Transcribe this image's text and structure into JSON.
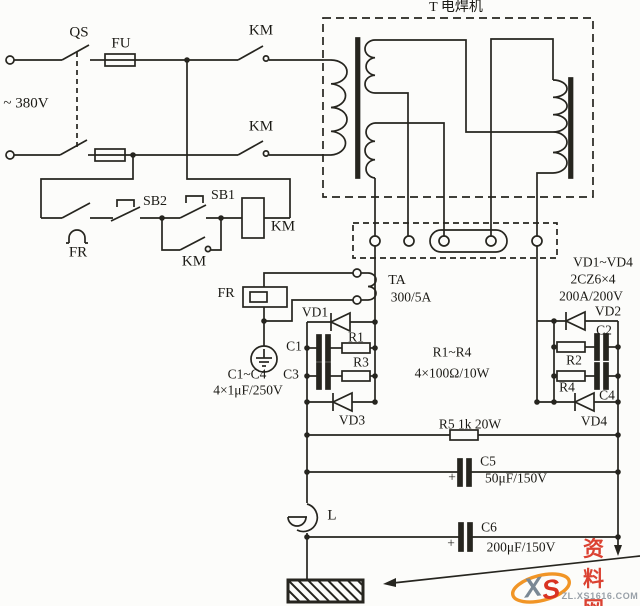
{
  "colors": {
    "line": "#26251f",
    "label": "#1b1a15",
    "background": "#fcfcfa",
    "wm_red": "#d93322",
    "wm_orange": "#ee8200",
    "wm_gray": "#98a0a8"
  },
  "power": {
    "supply": "~ 380V",
    "qs": "QS",
    "fu": "FU",
    "km_top": "KM",
    "km_mid": "KM"
  },
  "control": {
    "fr_contact": "FR",
    "sb2": "SB2",
    "sb1": "SB1",
    "km_coil": "KM",
    "km_aux": "KM",
    "fr_heater": "FR"
  },
  "transformer": {
    "title": "T 电焊机"
  },
  "ta": {
    "name": "TA",
    "ratio": "300/5A"
  },
  "rectifier": {
    "note1": "VD1~VD4",
    "note2": "2CZ6×4",
    "note3": "200A/200V",
    "vd1": "VD1",
    "vd2": "VD2",
    "vd3": "VD3",
    "vd4": "VD4",
    "c1": "C1",
    "c2": "C2",
    "c3": "C3",
    "c4": "C4",
    "r1": "R1",
    "r2": "R2",
    "r3": "R3",
    "r4": "R4",
    "r_note1": "R1~R4",
    "r_note2": "4×100Ω/10W",
    "c_note1": "C1~C4",
    "c_note2": "4×1μF/250V"
  },
  "output": {
    "r5": "R5 1k 20W",
    "c5": "C5",
    "c5_value": "50μF/150V",
    "c5_plus": "+",
    "c6": "C6",
    "c6_value": "200μF/150V",
    "c6_plus": "+",
    "l": "L"
  },
  "watermark": {
    "logo_x": "X",
    "logo_s": "S",
    "site": "资料网",
    "url": "ZL.XS1616.COM"
  }
}
